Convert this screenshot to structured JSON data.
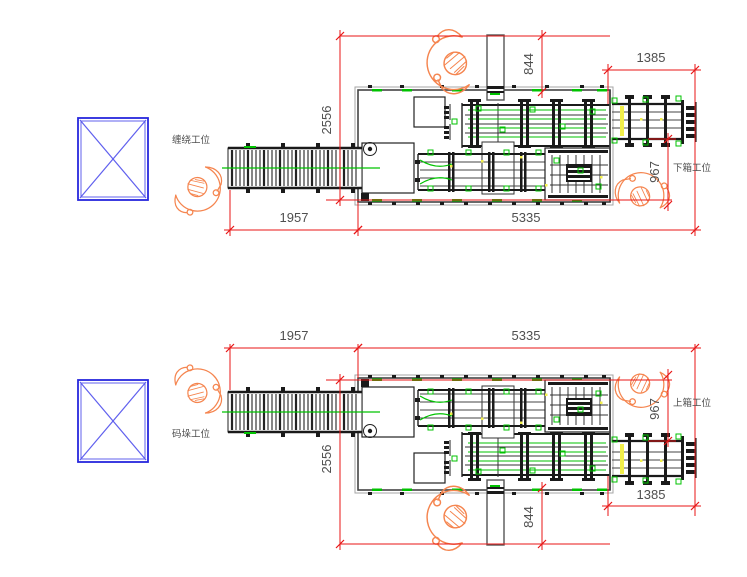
{
  "drawing": {
    "title": "packing-line-layout-plan",
    "colors": {
      "background": "#ffffff",
      "dimension_red": "#e81616",
      "annotation_gray": "#4f4f4f",
      "machine_black": "#1a1a1a",
      "machine_mid": "#444444",
      "frame_gray": "#a5a5a5",
      "accent_green": "#00c300",
      "accent_yellow": "#f2ef4a",
      "pallet_blue": "#2727dd",
      "pallet_blue_light": "#6060ee",
      "worker_orange": "#f5854f"
    },
    "diagrams": [
      {
        "id": "top",
        "station_labels": [
          {
            "id": "left",
            "text": "缠绕工位"
          },
          {
            "id": "right",
            "text": "下箱工位"
          }
        ],
        "dimensions": [
          {
            "id": "d844",
            "value": "844"
          },
          {
            "id": "d1385",
            "value": "1385"
          },
          {
            "id": "d2556",
            "value": "2556"
          },
          {
            "id": "d967",
            "value": "967"
          },
          {
            "id": "d1957",
            "value": "1957"
          },
          {
            "id": "d5335",
            "value": "5335"
          }
        ]
      },
      {
        "id": "bottom",
        "station_labels": [
          {
            "id": "left",
            "text": "码垛工位"
          },
          {
            "id": "right",
            "text": "上箱工位"
          }
        ],
        "dimensions": [
          {
            "id": "d844",
            "value": "844"
          },
          {
            "id": "d1385",
            "value": "1385"
          },
          {
            "id": "d2556",
            "value": "2556"
          },
          {
            "id": "d967",
            "value": "967"
          },
          {
            "id": "d1957",
            "value": "1957"
          },
          {
            "id": "d5335",
            "value": "5335"
          }
        ]
      }
    ]
  }
}
